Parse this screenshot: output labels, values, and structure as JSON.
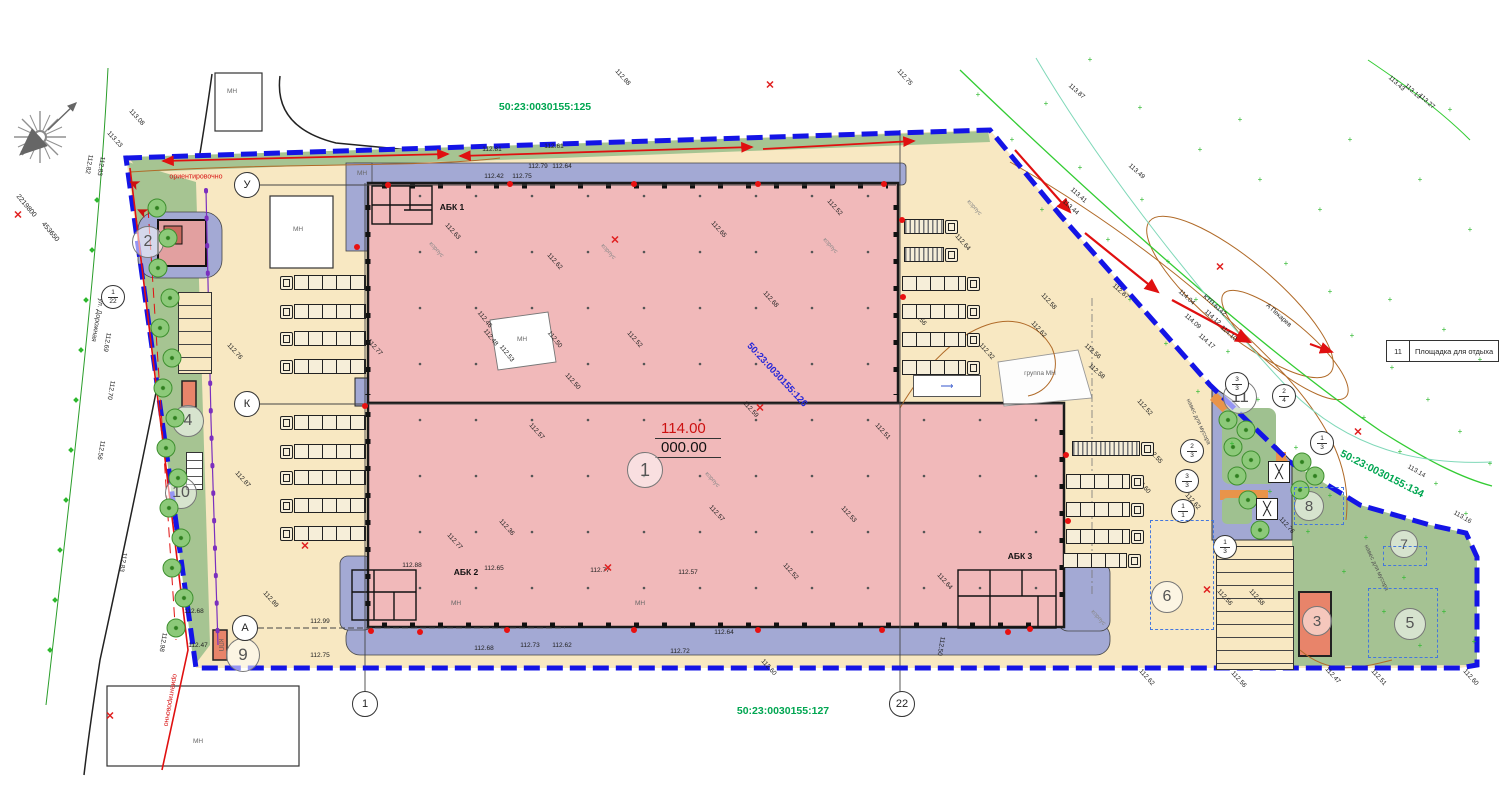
{
  "cadastral": {
    "top": "50:23:0030155:125",
    "bottom": "50:23:0030155:127",
    "right": "50:23:0030155:134",
    "inner": "50:23:0030155:126"
  },
  "legend": {
    "number": "11",
    "label": "Площадка для отдыха"
  },
  "elevation_main": {
    "red": "114.00",
    "black": "000.00"
  },
  "area_circles": [
    {
      "n": "1",
      "x": 645,
      "y": 470,
      "d": 34
    },
    {
      "n": "2",
      "x": 148,
      "y": 242,
      "d": 30
    },
    {
      "n": "3",
      "x": 1317,
      "y": 621,
      "d": 28
    },
    {
      "n": "4",
      "x": 188,
      "y": 421,
      "d": 30
    },
    {
      "n": "5",
      "x": 1410,
      "y": 624,
      "d": 30
    },
    {
      "n": "6",
      "x": 1167,
      "y": 597,
      "d": 30
    },
    {
      "n": "7",
      "x": 1404,
      "y": 544,
      "d": 26
    },
    {
      "n": "8",
      "x": 1309,
      "y": 506,
      "d": 28
    },
    {
      "n": "9",
      "x": 243,
      "y": 655,
      "d": 32
    },
    {
      "n": "10",
      "x": 181,
      "y": 493,
      "d": 30
    },
    {
      "n": "11",
      "x": 1240,
      "y": 397,
      "d": 32
    }
  ],
  "axis_circles": [
    {
      "n": "У",
      "x": 247,
      "y": 185
    },
    {
      "n": "К",
      "x": 247,
      "y": 404
    },
    {
      "n": "А",
      "x": 245,
      "y": 628
    },
    {
      "n": "1",
      "x": 365,
      "y": 704
    },
    {
      "n": "22",
      "x": 902,
      "y": 704
    }
  ],
  "fractions": [
    {
      "a": "1",
      "b": "22",
      "x": 113,
      "y": 297
    },
    {
      "a": "3",
      "b": "3",
      "x": 1237,
      "y": 384
    },
    {
      "a": "2",
      "b": "4",
      "x": 1284,
      "y": 396
    },
    {
      "a": "1",
      "b": "3",
      "x": 1322,
      "y": 443
    },
    {
      "a": "2",
      "b": "3",
      "x": 1192,
      "y": 451
    },
    {
      "a": "3",
      "b": "3",
      "x": 1187,
      "y": 481
    },
    {
      "a": "1",
      "b": "1",
      "x": 1183,
      "y": 511
    },
    {
      "a": "1",
      "b": "3",
      "x": 1225,
      "y": 547
    }
  ],
  "labels": [
    {
      "t": "АБК 1",
      "x": 452,
      "y": 207,
      "c": "abk"
    },
    {
      "t": "АБК 2",
      "x": 466,
      "y": 572,
      "c": "abk"
    },
    {
      "t": "АБК 3",
      "x": 1020,
      "y": 556,
      "c": "abk"
    },
    {
      "t": "ул. Дорожная",
      "x": 97,
      "y": 320,
      "r": 100,
      "c": "street"
    },
    {
      "t": "ориентировочно",
      "x": 196,
      "y": 177,
      "c": "red"
    },
    {
      "t": "ориентировочно",
      "x": 170,
      "y": 700,
      "r": 100,
      "c": "red"
    },
    {
      "t": "А Пекарев",
      "x": 1278,
      "y": 316,
      "r": 42,
      "c": ""
    },
    {
      "t": "КТП 6142",
      "x": 1214,
      "y": 306,
      "r": 42,
      "c": ""
    },
    {
      "t": "КПП",
      "x": 220,
      "y": 645,
      "r": 90,
      "c": "nav"
    },
    {
      "t": "2219800",
      "x": 26,
      "y": 206,
      "r": 50,
      "c": "coord"
    },
    {
      "t": "453650",
      "x": 50,
      "y": 232,
      "r": 50,
      "c": "coord"
    },
    {
      "t": "МН",
      "x": 232,
      "y": 92,
      "c": "mn"
    },
    {
      "t": "МН",
      "x": 298,
      "y": 230,
      "c": "mn"
    },
    {
      "t": "МН",
      "x": 198,
      "y": 742,
      "c": "mn"
    },
    {
      "t": "МН",
      "x": 362,
      "y": 174,
      "c": "mn"
    },
    {
      "t": "МН",
      "x": 522,
      "y": 340,
      "c": "mn"
    },
    {
      "t": "МН",
      "x": 456,
      "y": 604,
      "c": "mn"
    },
    {
      "t": "МН",
      "x": 640,
      "y": 604,
      "c": "mn"
    },
    {
      "t": "группа МН",
      "x": 1040,
      "y": 374,
      "c": "mn"
    },
    {
      "t": "навес для мусора",
      "x": 1198,
      "y": 422,
      "r": 65,
      "c": "nav"
    },
    {
      "t": "навес для мусора",
      "x": 1376,
      "y": 568,
      "r": 65,
      "c": "nav"
    },
    {
      "t": "корпус",
      "x": 436,
      "y": 250,
      "r": 48,
      "c": "kor"
    },
    {
      "t": "корпус",
      "x": 608,
      "y": 252,
      "r": 48,
      "c": "kor"
    },
    {
      "t": "корпус",
      "x": 712,
      "y": 480,
      "r": 48,
      "c": "kor"
    },
    {
      "t": "корпус",
      "x": 974,
      "y": 208,
      "r": 48,
      "c": "kor"
    },
    {
      "t": "корпус",
      "x": 1098,
      "y": 618,
      "r": 48,
      "c": "kor"
    },
    {
      "t": "корпус",
      "x": 830,
      "y": 246,
      "r": 48,
      "c": "kor"
    },
    {
      "t": "113.08",
      "x": 136,
      "y": 118,
      "r": 48
    },
    {
      "t": "113.23",
      "x": 114,
      "y": 140,
      "r": 48
    },
    {
      "t": "112.82",
      "x": 88,
      "y": 164,
      "r": 100
    },
    {
      "t": "112.83",
      "x": 100,
      "y": 166,
      "r": 100
    },
    {
      "t": "112.69",
      "x": 106,
      "y": 342,
      "r": 100
    },
    {
      "t": "112.70",
      "x": 110,
      "y": 390,
      "r": 100
    },
    {
      "t": "112.56",
      "x": 100,
      "y": 450,
      "r": 100
    },
    {
      "t": "112.83",
      "x": 122,
      "y": 562,
      "r": 100
    },
    {
      "t": "112.98",
      "x": 162,
      "y": 642,
      "r": 100
    },
    {
      "t": "112.68",
      "x": 194,
      "y": 612
    },
    {
      "t": "112.47",
      "x": 198,
      "y": 646
    },
    {
      "t": "112.89",
      "x": 270,
      "y": 600,
      "r": 48
    },
    {
      "t": "112.99",
      "x": 320,
      "y": 622
    },
    {
      "t": "112.75",
      "x": 320,
      "y": 656
    },
    {
      "t": "112.76",
      "x": 234,
      "y": 352,
      "r": 48
    },
    {
      "t": "112.87",
      "x": 242,
      "y": 480,
      "r": 48
    },
    {
      "t": "112.81",
      "x": 492,
      "y": 150
    },
    {
      "t": "112.61",
      "x": 554,
      "y": 147
    },
    {
      "t": "112.79",
      "x": 538,
      "y": 167
    },
    {
      "t": "112.64",
      "x": 562,
      "y": 167
    },
    {
      "t": "112.42",
      "x": 494,
      "y": 177
    },
    {
      "t": "112.75",
      "x": 522,
      "y": 177
    },
    {
      "t": "112.88",
      "x": 622,
      "y": 78,
      "r": 48
    },
    {
      "t": "112.75",
      "x": 904,
      "y": 78,
      "r": 48
    },
    {
      "t": "112.63",
      "x": 452,
      "y": 232,
      "r": 48
    },
    {
      "t": "112.62",
      "x": 554,
      "y": 262,
      "r": 48
    },
    {
      "t": "112.65",
      "x": 718,
      "y": 230,
      "r": 48
    },
    {
      "t": "112.52",
      "x": 834,
      "y": 208,
      "r": 48
    },
    {
      "t": "112.46",
      "x": 484,
      "y": 320,
      "r": 52
    },
    {
      "t": "112.48",
      "x": 490,
      "y": 338,
      "r": 52
    },
    {
      "t": "112.53",
      "x": 506,
      "y": 354,
      "r": 52
    },
    {
      "t": "112.50",
      "x": 554,
      "y": 340,
      "r": 52
    },
    {
      "t": "112.52",
      "x": 634,
      "y": 340,
      "r": 48
    },
    {
      "t": "112.50",
      "x": 572,
      "y": 382,
      "r": 48
    },
    {
      "t": "112.68",
      "x": 770,
      "y": 300,
      "r": 48
    },
    {
      "t": "112.59",
      "x": 750,
      "y": 410,
      "r": 48
    },
    {
      "t": "112.51",
      "x": 882,
      "y": 432,
      "r": 48
    },
    {
      "t": "112.77",
      "x": 374,
      "y": 348,
      "r": 48
    },
    {
      "t": "112.57",
      "x": 536,
      "y": 432,
      "r": 48
    },
    {
      "t": "112.53",
      "x": 848,
      "y": 515,
      "r": 48
    },
    {
      "t": "112.57",
      "x": 716,
      "y": 514,
      "r": 48
    },
    {
      "t": "112.36",
      "x": 506,
      "y": 528,
      "r": 48
    },
    {
      "t": "112.77",
      "x": 454,
      "y": 542,
      "r": 48
    },
    {
      "t": "112.52",
      "x": 790,
      "y": 572,
      "r": 48
    },
    {
      "t": "112.88",
      "x": 412,
      "y": 566
    },
    {
      "t": "112.65",
      "x": 494,
      "y": 569
    },
    {
      "t": "112.77",
      "x": 600,
      "y": 571
    },
    {
      "t": "112.57",
      "x": 688,
      "y": 573
    },
    {
      "t": "112.64",
      "x": 724,
      "y": 633
    },
    {
      "t": "112.73",
      "x": 530,
      "y": 646
    },
    {
      "t": "112.62",
      "x": 562,
      "y": 646
    },
    {
      "t": "112.68",
      "x": 484,
      "y": 649
    },
    {
      "t": "112.72",
      "x": 680,
      "y": 652
    },
    {
      "t": "112.60",
      "x": 768,
      "y": 668,
      "r": 48
    },
    {
      "t": "112.64",
      "x": 962,
      "y": 243,
      "r": 48
    },
    {
      "t": "112.56",
      "x": 918,
      "y": 318,
      "r": 48
    },
    {
      "t": "112.58",
      "x": 1048,
      "y": 302,
      "r": 48
    },
    {
      "t": "112.62",
      "x": 1038,
      "y": 330,
      "r": 48
    },
    {
      "t": "112.32",
      "x": 986,
      "y": 352,
      "r": 48
    },
    {
      "t": "112.52",
      "x": 1144,
      "y": 408,
      "r": 48
    },
    {
      "t": "112.55",
      "x": 1154,
      "y": 456,
      "r": 48
    },
    {
      "t": "112.60",
      "x": 1142,
      "y": 486,
      "r": 48
    },
    {
      "t": "112.62",
      "x": 1192,
      "y": 502,
      "r": 48
    },
    {
      "t": "112.64",
      "x": 944,
      "y": 582,
      "r": 48
    },
    {
      "t": "112.50",
      "x": 940,
      "y": 646,
      "r": 100
    },
    {
      "t": "112.87",
      "x": 1120,
      "y": 292,
      "r": 42
    },
    {
      "t": "112.56",
      "x": 1092,
      "y": 352,
      "r": 42
    },
    {
      "t": "112.58",
      "x": 1096,
      "y": 372,
      "r": 42
    },
    {
      "t": "114.04",
      "x": 1186,
      "y": 298,
      "r": 42
    },
    {
      "t": "114.12",
      "x": 1212,
      "y": 318,
      "r": 42
    },
    {
      "t": "114.09",
      "x": 1192,
      "y": 322,
      "r": 42
    },
    {
      "t": "114.10",
      "x": 1228,
      "y": 334,
      "r": 42
    },
    {
      "t": "114.17",
      "x": 1206,
      "y": 342,
      "r": 42
    },
    {
      "t": "113.87",
      "x": 1076,
      "y": 92,
      "r": 42
    },
    {
      "t": "113.49",
      "x": 1136,
      "y": 172,
      "r": 42
    },
    {
      "t": "113.41",
      "x": 1078,
      "y": 196,
      "r": 42
    },
    {
      "t": "113.44",
      "x": 1070,
      "y": 208,
      "r": 42
    },
    {
      "t": "113.43",
      "x": 1396,
      "y": 84,
      "r": 42
    },
    {
      "t": "113.13",
      "x": 1412,
      "y": 92,
      "r": 42
    },
    {
      "t": "113.27",
      "x": 1426,
      "y": 102,
      "r": 42
    },
    {
      "t": "113.14",
      "x": 1416,
      "y": 472,
      "r": 30
    },
    {
      "t": "113.16",
      "x": 1462,
      "y": 518,
      "r": 30
    },
    {
      "t": "112.76",
      "x": 1286,
      "y": 526,
      "r": 48
    },
    {
      "t": "112.56",
      "x": 1224,
      "y": 598,
      "r": 48
    },
    {
      "t": "112.58",
      "x": 1256,
      "y": 598,
      "r": 48
    },
    {
      "t": "112.62",
      "x": 1146,
      "y": 678,
      "r": 48
    },
    {
      "t": "112.56",
      "x": 1238,
      "y": 680,
      "r": 48
    },
    {
      "t": "112.47",
      "x": 1332,
      "y": 676,
      "r": 48
    },
    {
      "t": "112.51",
      "x": 1378,
      "y": 678,
      "r": 48
    },
    {
      "t": "112.60",
      "x": 1470,
      "y": 678,
      "r": 48
    }
  ],
  "trucks": [
    {
      "x": 280,
      "y": 275,
      "d": "E",
      "l": 86
    },
    {
      "x": 280,
      "y": 304,
      "d": "E",
      "l": 86
    },
    {
      "x": 280,
      "y": 331,
      "d": "E",
      "l": 86
    },
    {
      "x": 280,
      "y": 359,
      "d": "E",
      "l": 86
    },
    {
      "x": 280,
      "y": 415,
      "d": "E",
      "l": 86
    },
    {
      "x": 280,
      "y": 444,
      "d": "E",
      "l": 86
    },
    {
      "x": 280,
      "y": 470,
      "d": "E",
      "l": 86
    },
    {
      "x": 280,
      "y": 498,
      "d": "E",
      "l": 86
    },
    {
      "x": 280,
      "y": 526,
      "d": "E",
      "l": 86
    },
    {
      "x": 904,
      "y": 219,
      "d": "W",
      "l": 54,
      "s": 1
    },
    {
      "x": 904,
      "y": 247,
      "d": "W",
      "l": 54,
      "s": 1
    },
    {
      "x": 902,
      "y": 276,
      "d": "W",
      "l": 78
    },
    {
      "x": 902,
      "y": 304,
      "d": "W",
      "l": 78
    },
    {
      "x": 902,
      "y": 332,
      "d": "W",
      "l": 78
    },
    {
      "x": 902,
      "y": 360,
      "d": "W",
      "l": 78
    },
    {
      "x": 1072,
      "y": 441,
      "d": "W",
      "l": 82,
      "s": 1
    },
    {
      "x": 1066,
      "y": 474,
      "d": "W",
      "l": 78
    },
    {
      "x": 1066,
      "y": 502,
      "d": "W",
      "l": 78
    },
    {
      "x": 1066,
      "y": 529,
      "d": "W",
      "l": 78
    },
    {
      "x": 1063,
      "y": 553,
      "d": "W",
      "l": 78
    }
  ],
  "trees": [
    [
      157,
      208
    ],
    [
      168,
      238
    ],
    [
      158,
      268
    ],
    [
      170,
      298
    ],
    [
      160,
      328
    ],
    [
      172,
      358
    ],
    [
      163,
      388
    ],
    [
      175,
      418
    ],
    [
      166,
      448
    ],
    [
      178,
      478
    ],
    [
      169,
      508
    ],
    [
      181,
      538
    ],
    [
      172,
      568
    ],
    [
      184,
      598
    ],
    [
      176,
      628
    ],
    [
      1228,
      420
    ],
    [
      1246,
      430
    ],
    [
      1233,
      447
    ],
    [
      1251,
      460
    ],
    [
      1237,
      476
    ],
    [
      1302,
      462
    ],
    [
      1315,
      476
    ],
    [
      1300,
      490
    ],
    [
      1248,
      500
    ],
    [
      1260,
      530
    ]
  ],
  "red_crosses": [
    [
      770,
      85
    ],
    [
      615,
      240
    ],
    [
      760,
      408
    ],
    [
      608,
      568
    ],
    [
      305,
      546
    ],
    [
      1207,
      590
    ],
    [
      1220,
      267
    ],
    [
      1358,
      432
    ],
    [
      110,
      716
    ],
    [
      18,
      215
    ]
  ],
  "red_dots": [
    [
      388,
      185
    ],
    [
      510,
      184
    ],
    [
      634,
      184
    ],
    [
      758,
      184
    ],
    [
      884,
      184
    ],
    [
      902,
      220
    ],
    [
      903,
      297
    ],
    [
      365,
      406
    ],
    [
      357,
      247
    ],
    [
      371,
      631
    ],
    [
      507,
      630
    ],
    [
      634,
      630
    ],
    [
      758,
      630
    ],
    [
      882,
      630
    ],
    [
      1008,
      632
    ],
    [
      1030,
      629
    ],
    [
      1066,
      455
    ],
    [
      1068,
      521
    ],
    [
      420,
      632
    ]
  ],
  "green_plus": [
    [
      978,
      95
    ],
    [
      1012,
      140
    ],
    [
      1046,
      104
    ],
    [
      1080,
      168
    ],
    [
      1042,
      210
    ],
    [
      1108,
      240
    ],
    [
      1142,
      200
    ],
    [
      1168,
      262
    ],
    [
      1130,
      300
    ],
    [
      1196,
      300
    ],
    [
      1166,
      344
    ],
    [
      1228,
      352
    ],
    [
      1198,
      392
    ],
    [
      1258,
      400
    ],
    [
      1232,
      444
    ],
    [
      1296,
      448
    ],
    [
      1270,
      492
    ],
    [
      1330,
      496
    ],
    [
      1308,
      532
    ],
    [
      1366,
      538
    ],
    [
      1344,
      572
    ],
    [
      1404,
      578
    ],
    [
      1384,
      612
    ],
    [
      1444,
      612
    ],
    [
      1420,
      646
    ],
    [
      1474,
      642
    ],
    [
      1364,
      418
    ],
    [
      1400,
      452
    ],
    [
      1436,
      484
    ],
    [
      1466,
      514
    ],
    [
      1352,
      336
    ],
    [
      1392,
      368
    ],
    [
      1428,
      400
    ],
    [
      1460,
      432
    ],
    [
      1490,
      464
    ],
    [
      1286,
      264
    ],
    [
      1330,
      292
    ],
    [
      1390,
      300
    ],
    [
      1444,
      330
    ],
    [
      1480,
      360
    ],
    [
      1200,
      150
    ],
    [
      1260,
      180
    ],
    [
      1320,
      210
    ],
    [
      1420,
      180
    ],
    [
      1470,
      230
    ],
    [
      1140,
      108
    ],
    [
      1240,
      120
    ],
    [
      1350,
      140
    ],
    [
      1450,
      110
    ],
    [
      1090,
      60
    ]
  ],
  "green_diamonds": [
    [
      97,
      200
    ],
    [
      92,
      250
    ],
    [
      86,
      300
    ],
    [
      81,
      350
    ],
    [
      76,
      400
    ],
    [
      71,
      450
    ],
    [
      66,
      500
    ],
    [
      60,
      550
    ],
    [
      55,
      600
    ],
    [
      50,
      650
    ]
  ],
  "dashed_rects": [
    [
      1150,
      520,
      62,
      108
    ],
    [
      1368,
      588,
      68,
      68
    ],
    [
      1383,
      546,
      42,
      18
    ],
    [
      1294,
      487,
      48,
      36
    ]
  ],
  "pavilions": [
    [
      1268,
      461
    ],
    [
      1256,
      498
    ]
  ]
}
